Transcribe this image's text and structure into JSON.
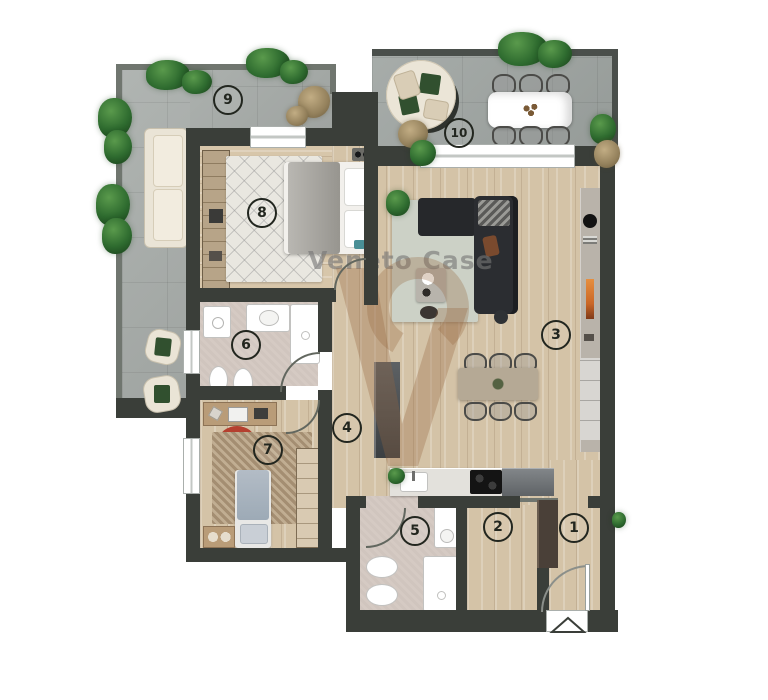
{
  "watermark": {
    "text": "Veneto Case"
  },
  "rooms": [
    {
      "number": "1"
    },
    {
      "number": "2"
    },
    {
      "number": "3"
    },
    {
      "number": "4"
    },
    {
      "number": "5"
    },
    {
      "number": "6"
    },
    {
      "number": "7"
    },
    {
      "number": "8"
    },
    {
      "number": "9"
    },
    {
      "number": "10"
    }
  ],
  "colors": {
    "wall": "#3a3e39",
    "terrace_tile": "#a7aca9",
    "wood_floor": "#d4c3a7",
    "bath_floor": "#d5cac3",
    "watermark_text": "#767676",
    "watermark_logo": "#96673f",
    "plant_green": "#2e6b2f",
    "red_chair": "#b5402f",
    "sofa_dark": "#2b2d31",
    "fireplace_orange": "#e8833a"
  },
  "entrance": {
    "marker": "triangle-arrow"
  }
}
